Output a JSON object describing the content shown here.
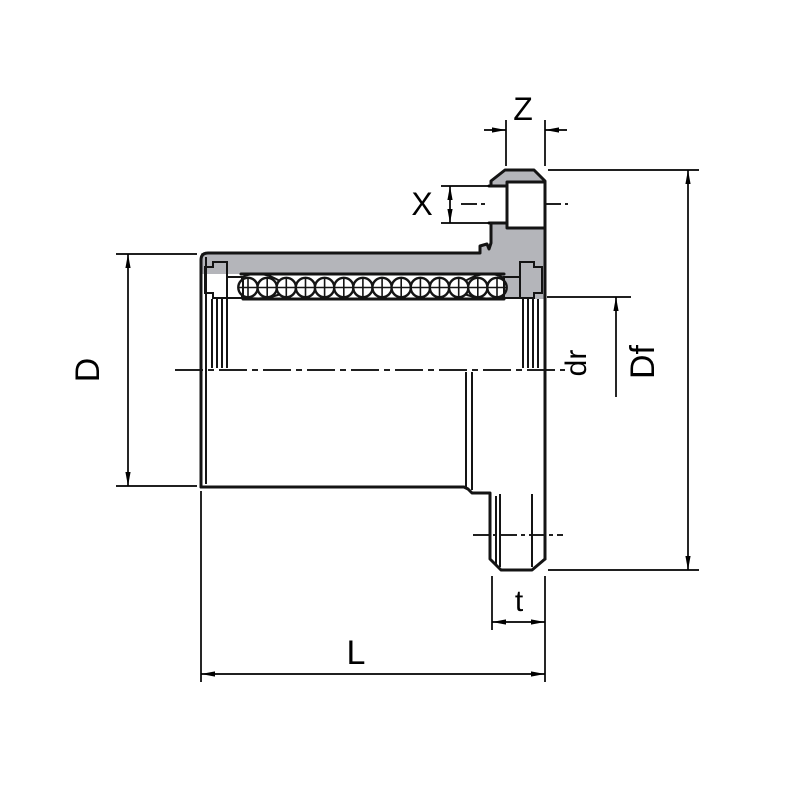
{
  "drawing": {
    "kind": "flanged-linear-ball-bearing-section",
    "background": "#ffffff",
    "section_color": "#b4b5ba",
    "seal_dark_color": "#686a72",
    "seal_light_color": "#cdd6ee",
    "ball_fill": "#ffffff",
    "line_color": "#141414",
    "dim_color": "#000000"
  },
  "dimension_labels": {
    "z": "Z",
    "x": "X",
    "d": "D",
    "dr": "dr",
    "df": "Df",
    "t": "t",
    "l": "L"
  }
}
